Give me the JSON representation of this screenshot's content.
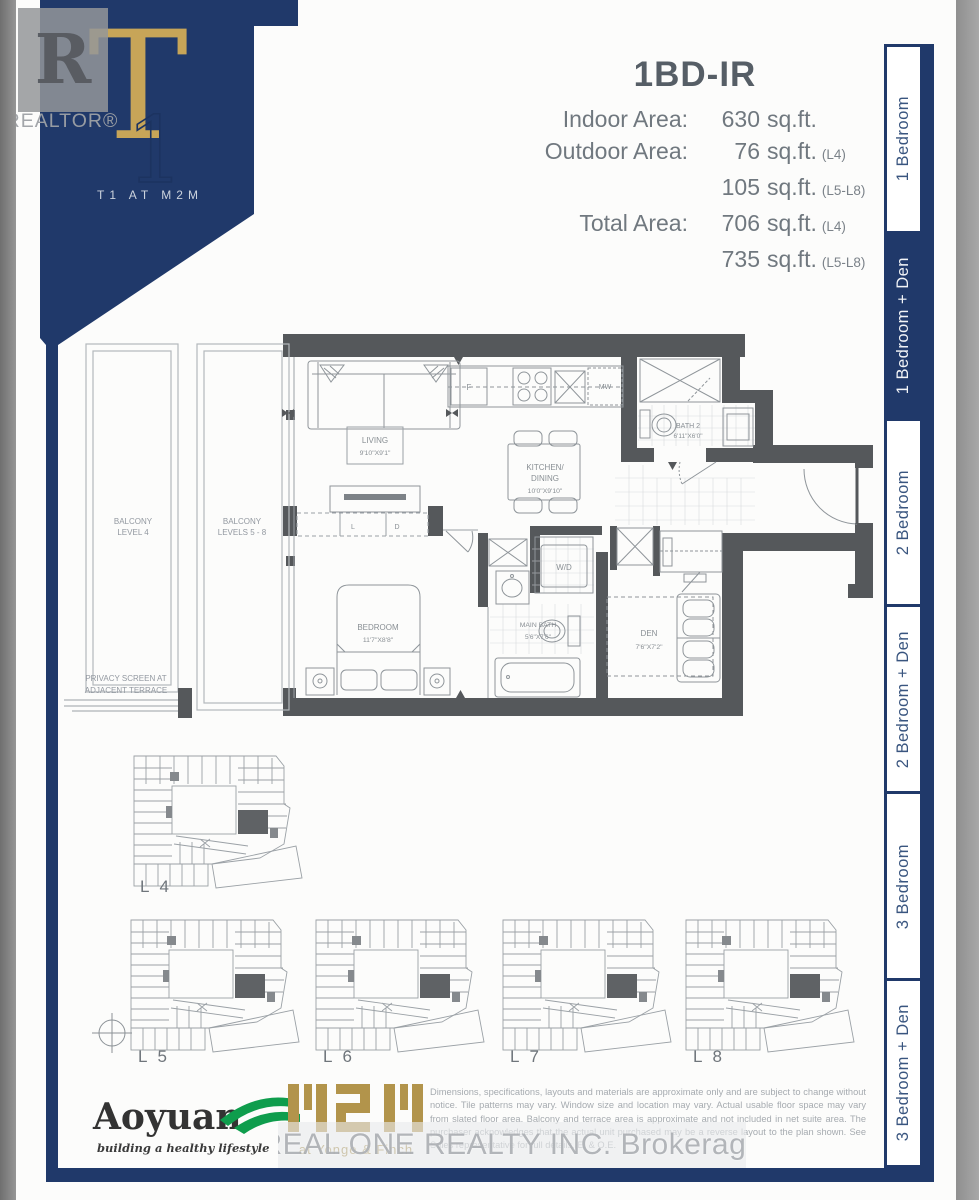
{
  "watermark_top": {
    "r": "R",
    "label": "REALTOR®"
  },
  "banner": {
    "t": "T",
    "one": "1",
    "project": "T1 AT M2M"
  },
  "header": {
    "title": "1BD-IR",
    "rows": [
      {
        "label": "Indoor Area:",
        "num": "630",
        "suffix": "sq.ft.",
        "note": ""
      },
      {
        "label": "Outdoor Area:",
        "num": "76",
        "suffix": "sq.ft.",
        "note": "(L4)"
      },
      {
        "label": "",
        "num": "105",
        "suffix": "sq.ft.",
        "note": "(L5-L8)"
      },
      {
        "label": "Total Area:",
        "num": "706",
        "suffix": "sq.ft.",
        "note": "(L4)"
      },
      {
        "label": "",
        "num": "735",
        "suffix": "sq.ft.",
        "note": "(L5-L8)"
      }
    ]
  },
  "tabs": [
    {
      "label": "1 Bedroom",
      "active": false
    },
    {
      "label": "1 Bedroom + Den",
      "active": true
    },
    {
      "label": "2 Bedroom",
      "active": false
    },
    {
      "label": "2 Bedroom + Den",
      "active": false
    },
    {
      "label": "3 Bedroom",
      "active": false
    },
    {
      "label": "3 Bedroom + Den",
      "active": false
    }
  ],
  "plan": {
    "living": {
      "name": "LIVING",
      "dims": "9'10\"X9'1\""
    },
    "kitchen": {
      "name1": "KITCHEN/",
      "name2": "DINING",
      "dims": "10'0\"X9'10\""
    },
    "bath2": {
      "name": "BATH 2",
      "dims": "6'11\"X6'0\""
    },
    "bedroom": {
      "name": "BEDROOM",
      "dims": "11'7\"X8'8\""
    },
    "main_bath": {
      "name": "MAIN BATH",
      "dims": "5'6\"X7'6\""
    },
    "den": {
      "name": "DEN",
      "dims": "7'6\"X7'2\""
    },
    "wd": "W/D",
    "fridge": "F",
    "microwave": "MW",
    "closet_l": "L",
    "closet_d": "D",
    "balcony1": [
      "BALCONY",
      "LEVEL 4"
    ],
    "balcony2": [
      "BALCONY",
      "LEVELS 5 - 8"
    ],
    "privacy": [
      "PRIVACY SCREEN AT",
      "ADJACENT TERRACE"
    ]
  },
  "keyplans": [
    {
      "label": "L 4"
    },
    {
      "label": "L 5"
    },
    {
      "label": "L 6"
    },
    {
      "label": "L 7"
    },
    {
      "label": "L 8"
    }
  ],
  "footer": {
    "aoyuan": "Aoyuan",
    "aoyuan_tagline": "building a healthy lifestyle",
    "m2m_sub": "at Yonge & Finch",
    "disclaimer": "Dimensions, specifications, layouts and materials are approximate only and are subject to change without notice. Tile patterns may vary. Window size and location may vary. Actual usable floor space may vary from slated floor area. Balcony and terrace area is approximate and not included in net suite area. The purchaser acknowledges that the actual unit purchased may be a reverse layout to the plan shown. See Sales representative for full details. E. & O.E."
  },
  "watermark_bottom": "REAL ONE REALTY INC. Brokerage",
  "colors": {
    "navy": "#20396a",
    "gold": "#c7a558",
    "green": "#0f9d4d",
    "wall": "#55585b",
    "m2m_gold": "#b2944b"
  }
}
